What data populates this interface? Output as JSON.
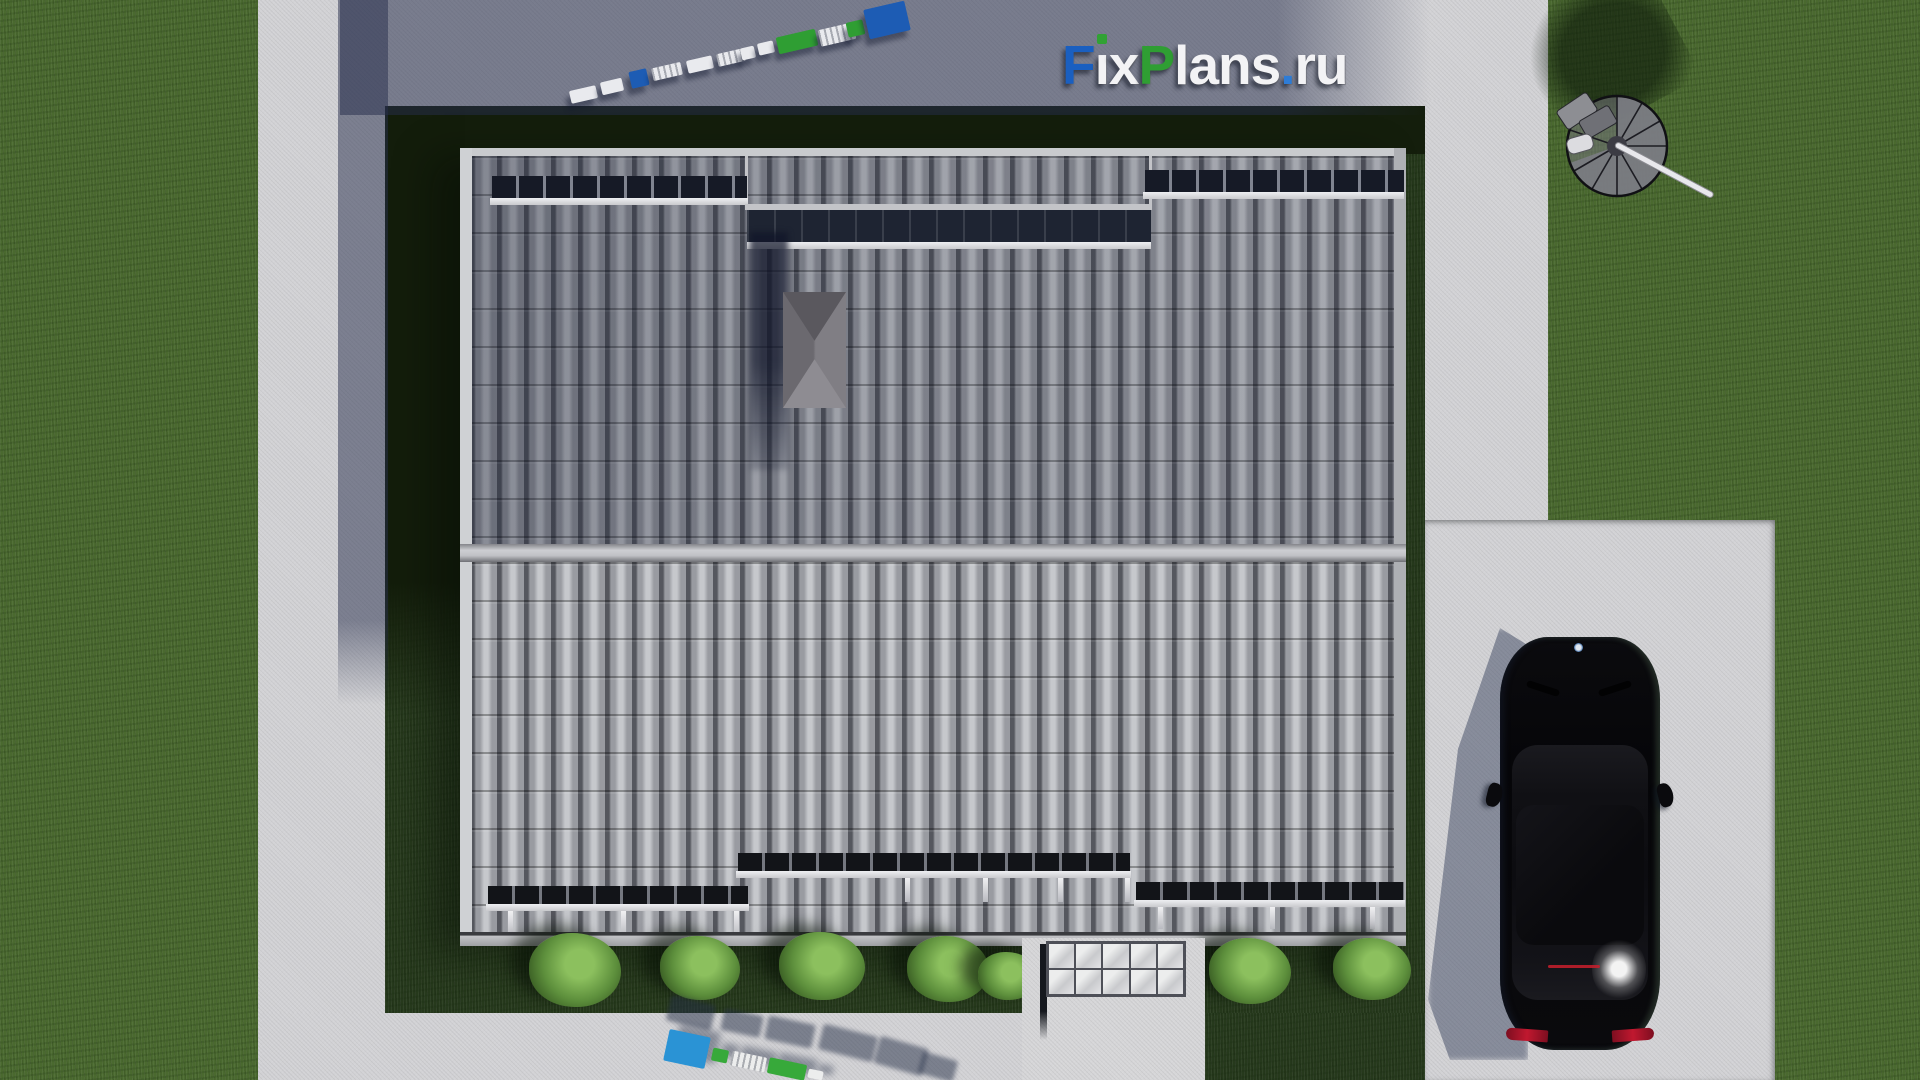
{
  "meta": {
    "description": "Top-down 3D architectural render of a house roof plan with surrounding lawn, concrete paths, driveway, parked black car and spiral staircase ornament",
    "view": "aerial top-down"
  },
  "watermark": {
    "text": "FixPlans.ru",
    "segments": [
      {
        "t": "F",
        "c": "#1a5fc0"
      },
      {
        "t": "i",
        "c": "#f3f3f5",
        "dot": "#31a234"
      },
      {
        "t": "x",
        "c": "#f3f3f5"
      },
      {
        "t": "P",
        "c": "#2f9e33"
      },
      {
        "t": "lans",
        "c": "#f3f3f5"
      },
      {
        "t": ".",
        "c": "#2e7cd6"
      },
      {
        "t": "ru",
        "c": "#f3f3f5"
      }
    ]
  },
  "palette": {
    "grass_sunlit": "#4a692f",
    "grass_yard": "#26391c",
    "grass_shadow": "#141e0c",
    "concrete": "#d2d2d5",
    "cast_shadow": "#262d4b",
    "roof_tile_light": "#c6c8cc",
    "roof_tile_mid": "#999ba1",
    "roof_tile_gap": "#55575e",
    "roof_upper_tint": "#1e243a",
    "ridge": "#c0c1c5",
    "snowguard_dark": "#121418",
    "snowguard_rail": "#d6d7da",
    "chimney": "#7b797f",
    "bush": "#6fa04a",
    "car_body": "#07070a",
    "car_glass": "#17171c",
    "taillight": "#c0182f",
    "logo_blue": "#1a5fc0",
    "logo_green": "#2f9e33",
    "logo_white": "#f3f3f5",
    "logo_cyan_blue": "#2a93d5"
  },
  "chains": {
    "top": {
      "rotation": -13,
      "blocks": [
        {
          "x": 570,
          "y": 88,
          "w": 27,
          "h": 13,
          "c": "#e9eaee"
        },
        {
          "x": 601,
          "y": 80,
          "w": 22,
          "h": 13,
          "c": "#e9eaee"
        },
        {
          "x": 630,
          "y": 70,
          "w": 18,
          "h": 17,
          "c": "#1d5cb4"
        },
        {
          "x": 652,
          "y": 65,
          "w": 30,
          "h": 13,
          "c": "#e9eaee",
          "striped": true
        },
        {
          "x": 687,
          "y": 58,
          "w": 26,
          "h": 13,
          "c": "#e9eaee"
        },
        {
          "x": 717,
          "y": 51,
          "w": 28,
          "h": 13,
          "c": "#e9eaee",
          "striped": true
        },
        {
          "x": 741,
          "y": 47,
          "w": 14,
          "h": 12,
          "c": "#e9eaee"
        },
        {
          "x": 758,
          "y": 42,
          "w": 16,
          "h": 12,
          "c": "#e9eaee"
        },
        {
          "x": 777,
          "y": 33,
          "w": 40,
          "h": 17,
          "c": "#2f9e33"
        },
        {
          "x": 819,
          "y": 26,
          "w": 36,
          "h": 17,
          "c": "#e9eaee",
          "striped": true
        },
        {
          "x": 847,
          "y": 21,
          "w": 17,
          "h": 15,
          "c": "#2f9e33"
        },
        {
          "x": 866,
          "y": 5,
          "w": 42,
          "h": 30,
          "c": "#1d5cb4"
        }
      ]
    },
    "bottom": {
      "rotation": 12,
      "blocks": [
        {
          "x": 666,
          "y": 1033,
          "w": 42,
          "h": 32,
          "c": "#2a93d5"
        },
        {
          "x": 712,
          "y": 1049,
          "w": 16,
          "h": 13,
          "c": "#37a93a"
        },
        {
          "x": 731,
          "y": 1054,
          "w": 35,
          "h": 15,
          "c": "#eceded",
          "striped": true
        },
        {
          "x": 768,
          "y": 1061,
          "w": 38,
          "h": 16,
          "c": "#37a93a"
        },
        {
          "x": 808,
          "y": 1070,
          "w": 15,
          "h": 9,
          "c": "#eceded"
        }
      ]
    }
  },
  "landscape": {
    "bushes": [
      {
        "x": 575,
        "y": 970,
        "r": 46
      },
      {
        "x": 700,
        "y": 968,
        "r": 40
      },
      {
        "x": 822,
        "y": 966,
        "r": 43
      },
      {
        "x": 948,
        "y": 969,
        "r": 41
      },
      {
        "x": 1008,
        "y": 976,
        "r": 30
      },
      {
        "x": 1250,
        "y": 971,
        "r": 41
      },
      {
        "x": 1372,
        "y": 969,
        "r": 39
      }
    ],
    "shadow_blobs": [
      {
        "x": 668,
        "y": 1000,
        "w": 46,
        "h": 26,
        "rot": 14
      },
      {
        "x": 722,
        "y": 1012,
        "w": 40,
        "h": 22,
        "rot": 12
      },
      {
        "x": 766,
        "y": 1020,
        "w": 48,
        "h": 24,
        "rot": 12
      },
      {
        "x": 820,
        "y": 1030,
        "w": 56,
        "h": 26,
        "rot": 14
      },
      {
        "x": 876,
        "y": 1042,
        "w": 50,
        "h": 28,
        "rot": 16
      },
      {
        "x": 920,
        "y": 1056,
        "w": 36,
        "h": 22,
        "rot": 16
      }
    ]
  }
}
